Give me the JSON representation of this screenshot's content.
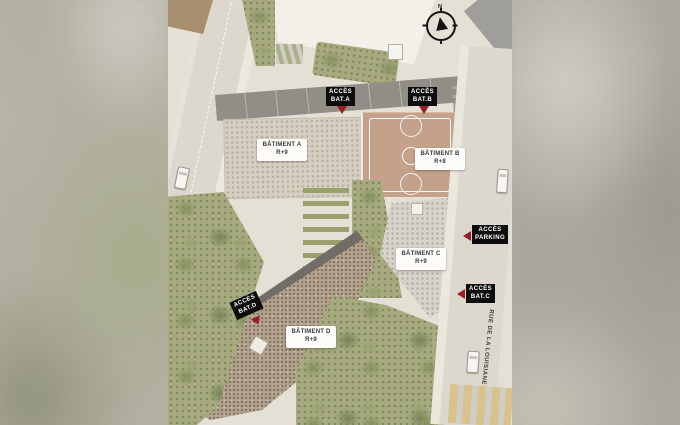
{
  "plan": {
    "type_label": "architectural site plan",
    "compass": {
      "north_label": "N"
    },
    "street": {
      "name": "RUE DE LA LOUISIANE"
    },
    "buildings": [
      {
        "name": "BÂTIMENT A",
        "level": "R+9"
      },
      {
        "name": "BÂTIMENT B",
        "level": "R+8"
      },
      {
        "name": "BÂTIMENT C",
        "level": "R+9"
      },
      {
        "name": "BÂTIMENT D",
        "level": "R+9"
      }
    ],
    "access_points": [
      {
        "line1": "ACCÈS",
        "line2": "BAT.A",
        "arrow": "down"
      },
      {
        "line1": "ACCÈS",
        "line2": "BAT.B",
        "arrow": "down"
      },
      {
        "line1": "ACCÈS",
        "line2": "PARKING",
        "arrow": "left"
      },
      {
        "line1": "ACCÈS",
        "line2": "BAT.C",
        "arrow": "left"
      },
      {
        "line1": "ACCÈS",
        "line2": "BAT.D",
        "arrow": "down"
      }
    ],
    "colors": {
      "tag_background": "#0d0d0d",
      "tag_text": "#ffffff",
      "marker_red": "#9b1e26",
      "building_card_background": "#fdfcf8",
      "building_card_text": "#3a3a3a",
      "roof_a": "#d6cfc1",
      "roof_c": "#d6d3ca",
      "roof_d": "#b1a08b",
      "court_terracotta": "#c3a18b",
      "greenery": "#a6aa7e",
      "pavement": "#e4e0d5",
      "road": "#dcd8cd",
      "access_band_gray": "#908e87",
      "crosswalk_yellow": "#d9c28b"
    }
  }
}
